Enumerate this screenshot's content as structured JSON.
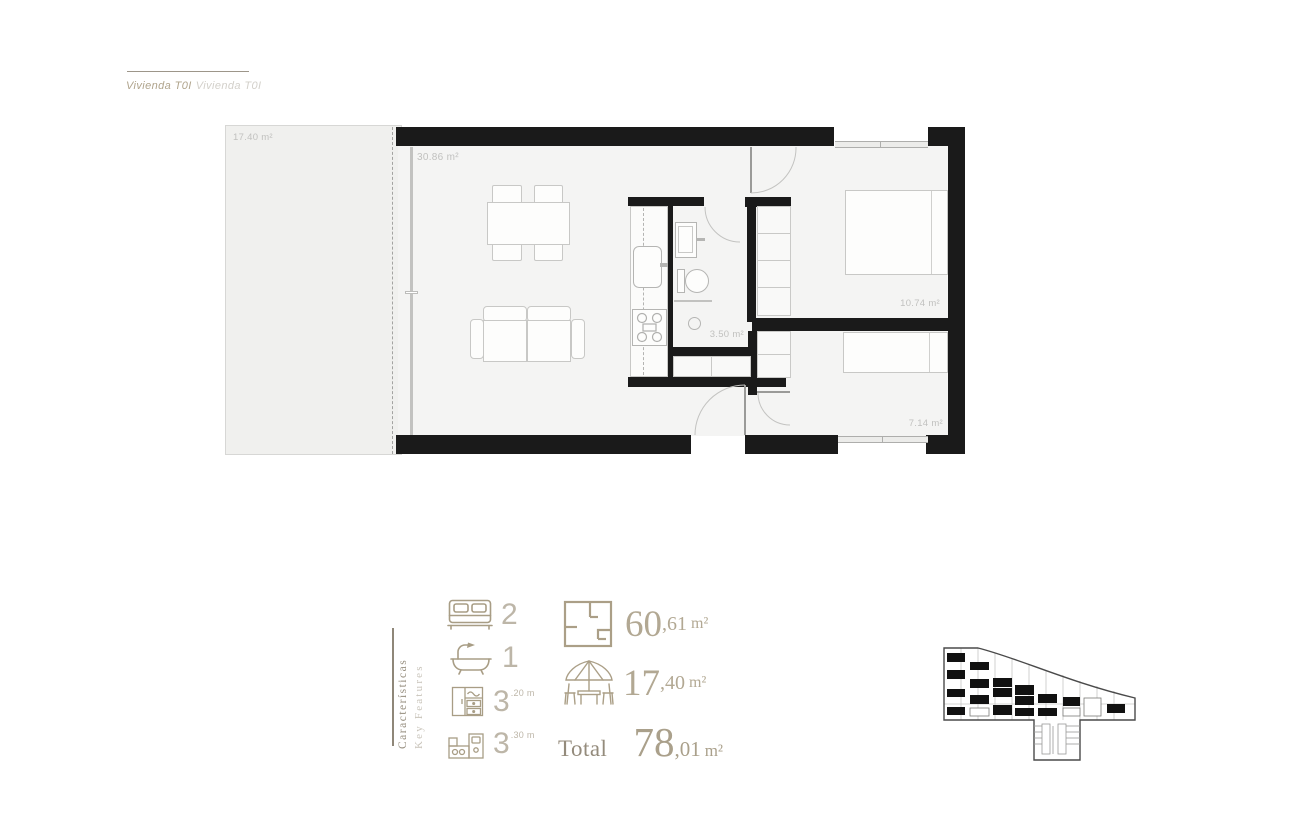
{
  "header": {
    "title_primary": "Vivienda T0I",
    "title_secondary": "Vivienda T0I"
  },
  "floorplan": {
    "labels": {
      "terrace": "17.40 m²",
      "living": "30.86 m²",
      "bathroom": "3.50 m²",
      "bedroom1": "10.74 m²",
      "bedroom2": "7.14 m²"
    }
  },
  "features": {
    "heading_primary": "Características",
    "heading_secondary": "Key Features",
    "counts": [
      {
        "icon": "bed-icon",
        "value": "2",
        "superscript": ""
      },
      {
        "icon": "bathtub-icon",
        "value": "1",
        "superscript": ""
      },
      {
        "icon": "wardrobe-icon",
        "value": "3",
        "superscript": ".20 m"
      },
      {
        "icon": "kitchen-icon",
        "value": "3",
        "superscript": ".30 m"
      }
    ],
    "areas": [
      {
        "icon": "floorplan-icon",
        "value": "60",
        "fraction": ",61",
        "unit": "m²"
      },
      {
        "icon": "terrace-icon",
        "value": "17",
        "fraction": ",40",
        "unit": "m²"
      }
    ],
    "total": {
      "label": "Total",
      "value": "78",
      "fraction": ",01",
      "unit": "m²"
    }
  },
  "colors": {
    "accent_tan": "#b2a893",
    "wall_black": "#1a1a1a",
    "label_gray": "#c1c1bf"
  }
}
